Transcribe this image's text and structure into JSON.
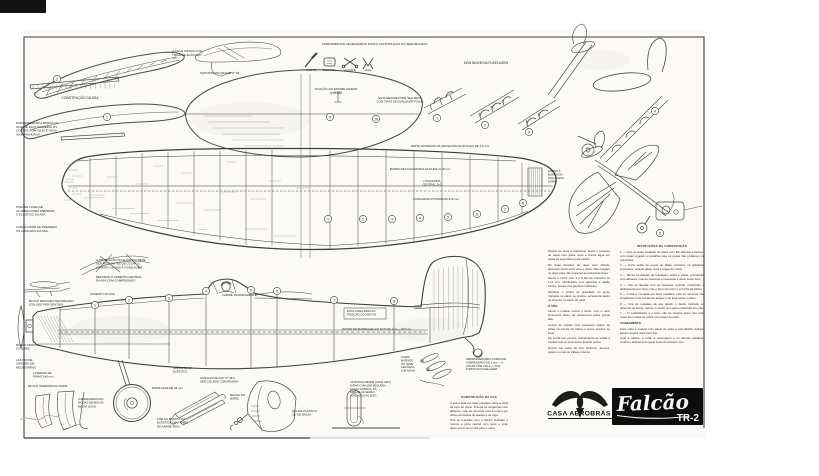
{
  "title_block": {
    "brand": "CASA AEROBRÁS",
    "model_name": "Falcão",
    "model_variant": "TR-2"
  },
  "tools": {
    "caption": "FERRAMENTAS NECESSÁRIAS PARA A CONSTRUÇÃO DO AEROMODELO",
    "items": [
      "GILETE",
      "TESOURA",
      "ALICATE",
      "LIXA"
    ]
  },
  "labels": {
    "construcao_asa": [
      "CONSTRUÇÃO DA ASA"
    ],
    "tl_note": [
      "PARA EMENDAR A BORDA DE",
      "ATAQUE FAÇA PRIMEIRO OS",
      "CORTES COM GILETE NOVA",
      "NAS RANHURAS"
    ],
    "holdown1": [
      "A ASA É FIXADA COM",
      "TIRAS DE ELÁSTICO"
    ],
    "holdown2": [
      "SUPORTE DE ARAME Nº 18"
    ],
    "stab1": [
      "FIXAÇÃO DO ESTABILIZADOR",
      "(FOLHA)"
    ],
    "stab2": [
      "ESTA METADE PODE SER FEITA",
      "COM TIRAS DE QUALQUER FOLHA"
    ],
    "montagem_fus": [
      "MONTAGEM DA FUSELAGEM"
    ],
    "wing_top": [
      "PARTE ANTERIOR DA ASA EM BALSA (FOLHA) DE 1,5 mm"
    ],
    "wing_bf": [
      "BORDA DE FUGA EM BALSA DURA 3×15 mm"
    ],
    "wing_lc": [
      "LONGARINA",
      "CENTRAL 3×3"
    ],
    "wing_lt": [
      "LONGARINA POSTERIOR 3×3 mm"
    ],
    "wingtip": [
      "PRESO À",
      "BORDA DA",
      "ASA (BALSA",
      "DURA)"
    ],
    "lm1": [
      "PINO DE LINHA DE",
      "ALUMÍNIO PARA PRENDER",
      "O ELÁSTICO DA ASA"
    ],
    "lm2": [
      "FUROS ONDE SE PRENDEM",
      "OS GANCHOS DA ASA"
    ],
    "saddle1": [
      "A INSTALAÇÃO DO ELÁSTICO DEVE",
      "SER FEITA ANTES DE COLAR O",
      "ASSENTO DA ASA À FUSELAGEM"
    ],
    "saddle2": [
      "REFORCE O ASSENTO CENTRAL",
      "DA ASA COM COMPENSADO"
    ],
    "assento": [
      "ASSENTO DA ASA"
    ],
    "cabine": [
      "CABINE TRANSPARENTE"
    ],
    "bloco_rec": [
      "BLOCO RECUADO REFORÇADO",
      "(COLADO POR DENTRO)"
    ],
    "bloco_frontal": [
      "BLOCO FRONTAL",
      "DO NARIZ"
    ],
    "lastro": [
      "LASTRO DE",
      "CHUMBO (SE",
      "NECESSÁRIO)"
    ],
    "laterais": [
      "LATERAIS DE",
      "PINHO 5×5 mm"
    ],
    "bloco_inf": [
      "BLOCO INFERIOR DO NARIZ"
    ],
    "roda": [
      "RODA LEVE DE 45 mm"
    ],
    "carenagem": [
      "CARENAGEM DAS",
      "RODAS EM BALSA",
      "MACIA (OCA)"
    ],
    "suporte": [
      "SUPORTE DO",
      "ELÁSTICO"
    ],
    "gancho": [
      "GANCHO DE AÇO Nº 18 A",
      "SER COLADO COM RESINA"
    ],
    "bucha": [
      "BUCHA DO",
      "NARIZ"
    ],
    "helice": [
      "HÉLICE PLÁSTICA",
      "OU DE BALSA"
    ],
    "roda_det": [
      "AS RODAS DEVEM (CADA UMA)",
      "GIRAR COM UMA PEQUENA",
      "FOLGA LATERAL; AS",
      "ARRUELAS SERÃO",
      "SOLDADAS AO EIXO"
    ],
    "parts_l": [
      "CHAPA",
      "BATENTE",
      "DO LEME",
      "VER DETA-",
      "LHE ACIMA"
    ],
    "parts_r": [
      "AMORTECEDORES: FUROS DE",
      "COMPENSADO DE 2 mm — A",
      "COLAR COM COLA — NOS",
      "FUROS DA FUSELAGEM"
    ],
    "motorstick": [
      "FIXE AS PONTAS DO",
      "ELÁSTICO COM ANÉIS",
      "DE ARAME FINO"
    ],
    "motorbox": [
      "ESTA LINHA INDICA A",
      "POSIÇÃO DO MOTOR"
    ],
    "motorlinha": [
      "MOTOR DE BORRACHA 4×6 FIOS DE 1×4 — 450 mm"
    ]
  },
  "callouts": {
    "wing_panels": [
      "1",
      "2"
    ],
    "stab_parts": [
      "9",
      "10"
    ],
    "assembly_steps": [
      "1",
      "2",
      "3"
    ],
    "tail_views": [
      "4",
      "5"
    ],
    "wing_ribs": [
      "1",
      "2",
      "3",
      "4",
      "5",
      "6",
      "7",
      "8"
    ],
    "fuselage_formers": [
      "1",
      "2",
      "3",
      "4",
      "5",
      "6",
      "7",
      "8"
    ]
  },
  "instructions": {
    "right_column": {
      "heading": "INSTRUÇÕES DA CONSTRUÇÃO",
      "paragraphs": [
        "1 — Cole as duas metades do plano com fita adesiva e cubra-o com papel vegetal ou parafina para as peças não grudarem na prancheta.",
        "2 — Corte todas as peças de balsa conforme os gabaritos impressos, usando gilete nova e régua de metal.",
        "3 — Monte as laterais da fuselagem sobre o plano, prendendo com alfinetes; cole as cavernas e travessas e deixe secar bem.",
        "4 — Una as laterais com as cavernas centrais, conferindo o alinhamento por cima; cole o bloco do nariz e a bucha da hélice.",
        "5 — A asa é montada em duas metades; cole as nervuras nas longarinas e nas bordas de ataque e de fuga sobre o plano.",
        "6 — Una as metades da asa dando o diedro indicado no desenho de frente; reforce o centro com gaze embebida em cola.",
        "7 — O estabilizador e o leme são de varetas leves; lixe tudo muito bem antes de cobrir com papel de seda."
      ],
      "subheading": "ACABAMENTO",
      "paragraphs2": [
        "Forre todo o modelo com papel de seda e cola diluída; aplique água e depois dope bem fino.",
        "Cole a cabine, a roda, a carenagem e os demais detalhes; confira o alinhamento geral antes do primeiro vôo."
      ]
    },
    "left_column": {
      "paragraphs": [
        "Depois de seca a cobertura, apare o excesso de papel com gilete nova e borrife água em todas as superfícies para esticar.",
        "Dê duas demãos de dope bem diluído, deixando secar entre uma e outra. Não exagere no dope para não empenar as estruturas leves.",
        "Monte o motor com 4 a 6 fios de borracha de 1×4 mm, lubrificados com glicerina e sabão neutro, presos nos ganchos indicados.",
        "Verifique o centro de gravidade no ponto marcado no plano; se preciso, acrescente lastro de chumbo no bloco do nariz."
      ],
      "subheading": "O VÔO",
      "paragraphs2": [
        "Lance o modelo contra o vento, com o nariz levemente baixo, de preferência sobre grama alta.",
        "Corrija as viradas com pequenos calços de balsa na bucha da hélice e leves torções no leme.",
        "Dê corda aos poucos, aumentando as voltas à medida que os vôos forem ficando certos.",
        "Nunca voe perto de fios elétricos, árvores, casas ou ruas de tráfego intenso."
      ]
    },
    "wing_note": {
      "heading": "CONSTRUÇÃO DA ASA",
      "paragraphs": [
        "A asa é feita em duas metades sobre a vista de topo do plano. Prenda as longarinas com alfinetes, cole as nervuras uma a uma e por último as bordas de ataque e de fuga.",
        "Una as metades com o diedro indicado e reforce a junta central com gaze e cola; deixe secar de um dia para o outro."
      ]
    }
  }
}
